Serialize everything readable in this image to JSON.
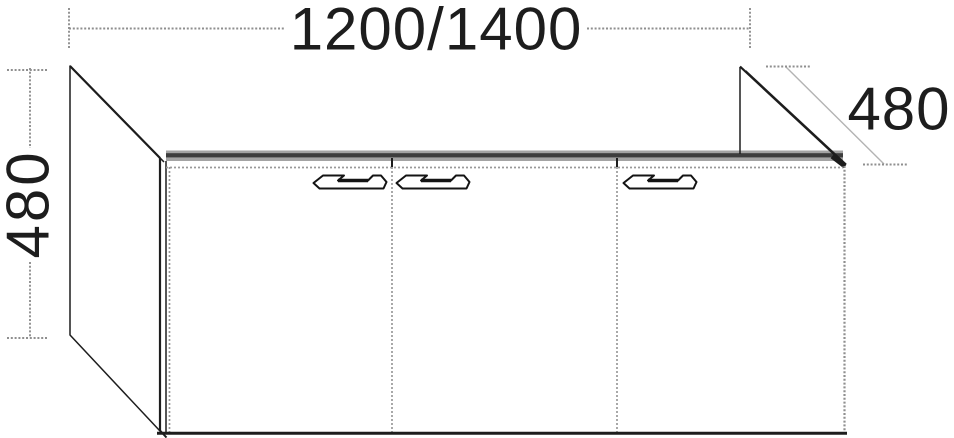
{
  "diagram": {
    "type": "furniture-technical-drawing",
    "subject": "three-door washbasin vanity unit shown in oblique perspective line drawing",
    "dimensions": {
      "width": {
        "label": "1200/1400",
        "placement": "horizontal-top"
      },
      "height": {
        "label": "480",
        "placement": "vertical-left-rotated"
      },
      "depth": {
        "label": "480",
        "placement": "diagonal-upper-right"
      }
    },
    "doors": [
      {
        "position": "left",
        "handle_location": "top-right-of-door"
      },
      {
        "position": "middle",
        "handle_location": "top-left-of-door"
      },
      {
        "position": "right",
        "handle_location": "top-left-of-door"
      }
    ],
    "colors": {
      "background": "#ffffff",
      "line": "#1d1d1d",
      "dimension_gray": "#8f8f8f",
      "top_edge_band_gray": "#a3a3a3",
      "top_edge_band_dark": "#3d3d3d"
    }
  }
}
